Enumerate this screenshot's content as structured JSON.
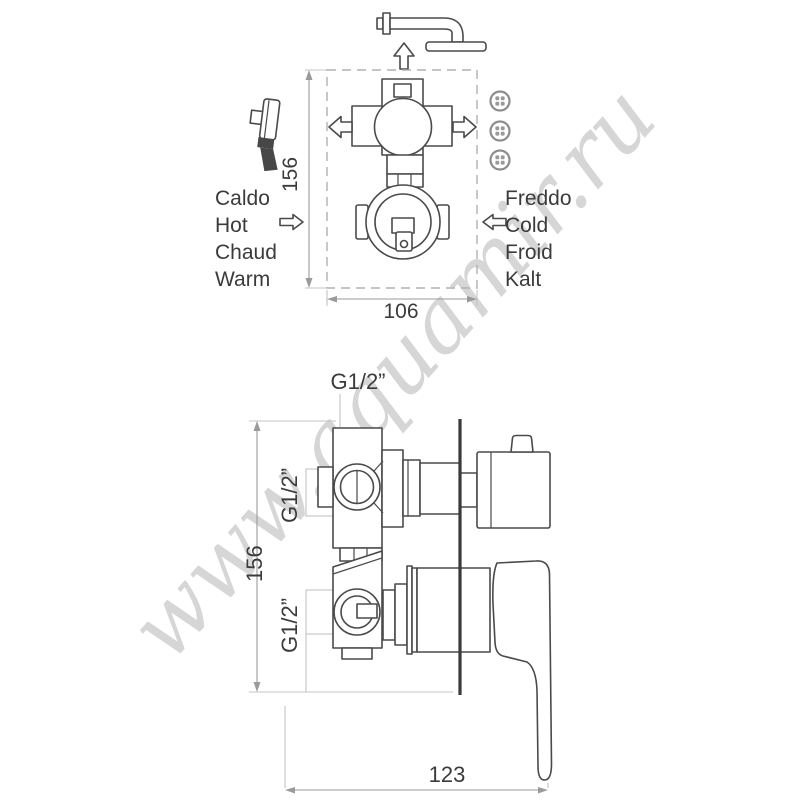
{
  "meta": {
    "background": "#ffffff",
    "line_color": "#4a4a4a",
    "dimension_color": "#9a9a9a",
    "watermark_color": "#d6d6d6"
  },
  "watermark": {
    "text": "www.aquamir.ru"
  },
  "icons": {
    "overhead_shower": "overhead-shower-icon",
    "hand_shower": "hand-shower-icon",
    "body_jets": "body-jets-icon",
    "flow_arrows": "flow-arrow-icon"
  },
  "top_view": {
    "hot_labels": [
      "Caldo",
      "Hot",
      "Chaud",
      "Warm"
    ],
    "cold_labels": [
      "Freddo",
      "Cold",
      "Froid",
      "Kalt"
    ],
    "dim_height": "156",
    "dim_width": "106"
  },
  "side_view": {
    "ports": {
      "top": "G1/2”",
      "middle": "G1/2”",
      "bottom": "G1/2”"
    },
    "dim_height": "156",
    "dim_depth": "123"
  }
}
